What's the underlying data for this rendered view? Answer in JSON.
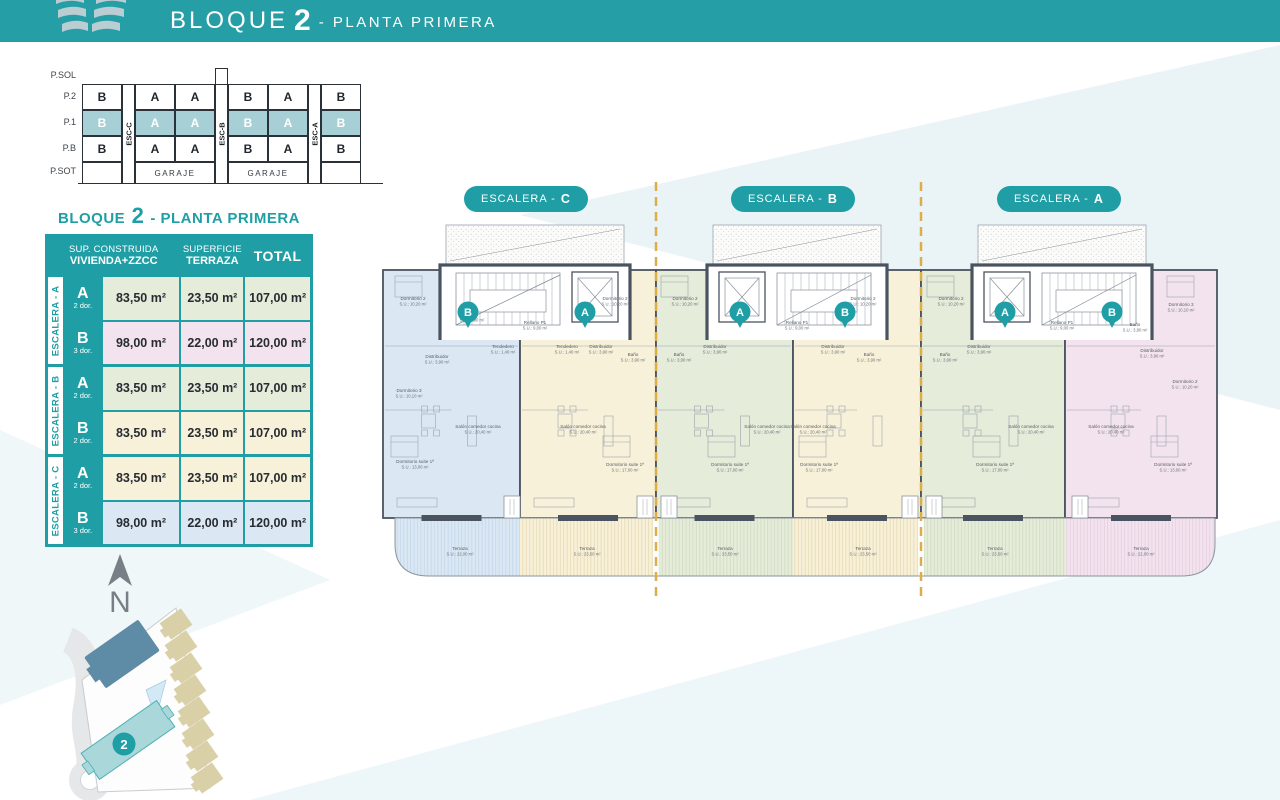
{
  "header": {
    "title_prefix": "BLOQUE",
    "title_number": "2",
    "title_suffix": "- PLANTA PRIMERA"
  },
  "colors": {
    "teal": "#1f9fa5",
    "wall": "#4a5360",
    "dash": "#dcae4b",
    "blue": "#dbe8f4",
    "cream": "#f8f1d9",
    "green": "#e5ecda",
    "pink": "#f3e3ee",
    "hblue": "#bdd3e8",
    "hcream": "#e3d6ab",
    "hgreen": "#ccd8bd",
    "hpink": "#e3cbdc"
  },
  "section_diagram": {
    "floors": [
      "P.SOL",
      "P.2",
      "P.1",
      "P.B",
      "P.SOT"
    ],
    "p2": [
      "B",
      "A",
      "A",
      "B",
      "A",
      "B"
    ],
    "p1": [
      "B",
      "A",
      "A",
      "B",
      "A",
      "B"
    ],
    "pb": [
      "B",
      "A",
      "A",
      "B",
      "A",
      "B"
    ],
    "esc": [
      "ESC-C",
      "ESC-B",
      "ESC-A"
    ],
    "garaje_left": "GARAJE",
    "garaje_right": "GARAJE"
  },
  "table": {
    "title_prefix": "BLOQUE",
    "title_number": "2",
    "title_suffix": "- PLANTA PRIMERA",
    "h_col1a": "SUP. CONSTRUIDA",
    "h_col1b": "VIVIENDA+ZZCC",
    "h_col2a": "SUPERFICIE",
    "h_col2b": "TERRAZA",
    "h_col3": "TOTAL",
    "groups": [
      {
        "label": "ESCALERA - A",
        "rows": [
          {
            "unit": "A",
            "dorms": "2 dor.",
            "sup": "83,50 m²",
            "terraza": "23,50 m²",
            "total": "107,00 m²",
            "bg": "#e5ecda"
          },
          {
            "unit": "B",
            "dorms": "3 dor.",
            "sup": "98,00 m²",
            "terraza": "22,00 m²",
            "total": "120,00 m²",
            "bg": "#f3e3ee"
          }
        ]
      },
      {
        "label": "ESCALERA - B",
        "rows": [
          {
            "unit": "A",
            "dorms": "2 dor.",
            "sup": "83,50 m²",
            "terraza": "23,50 m²",
            "total": "107,00 m²",
            "bg": "#e5ecda"
          },
          {
            "unit": "B",
            "dorms": "2 dor.",
            "sup": "83,50 m²",
            "terraza": "23,50 m²",
            "total": "107,00 m²",
            "bg": "#f8f1d9"
          }
        ]
      },
      {
        "label": "ESCALERA - C",
        "rows": [
          {
            "unit": "A",
            "dorms": "2 dor.",
            "sup": "83,50 m²",
            "terraza": "23,50 m²",
            "total": "107,00 m²",
            "bg": "#f8f1d9"
          },
          {
            "unit": "B",
            "dorms": "3 dor.",
            "sup": "98,00 m²",
            "terraza": "22,00 m²",
            "total": "120,00 m²",
            "bg": "#dbe8f4"
          }
        ]
      }
    ]
  },
  "plan": {
    "pills": [
      {
        "text": "ESCALERA -",
        "letter": "C"
      },
      {
        "text": "ESCALERA -",
        "letter": "B"
      },
      {
        "text": "ESCALERA -",
        "letter": "A"
      }
    ],
    "pins": [
      {
        "x": 93,
        "y": 134,
        "letter": "B"
      },
      {
        "x": 210,
        "y": 134,
        "letter": "A"
      },
      {
        "x": 365,
        "y": 134,
        "letter": "A"
      },
      {
        "x": 470,
        "y": 134,
        "letter": "B"
      },
      {
        "x": 630,
        "y": 134,
        "letter": "A"
      },
      {
        "x": 737,
        "y": 134,
        "letter": "B"
      }
    ],
    "rooms": [
      {
        "x": 38,
        "y": 122,
        "n": "Dormitorio 2",
        "s": "S.U.: 10,20 m²"
      },
      {
        "x": 97,
        "y": 138,
        "n": "Baño",
        "s": "S.U.: 3,90 m²"
      },
      {
        "x": 62,
        "y": 180,
        "n": "Distribuidor",
        "s": "S.U.: 3,90 m²"
      },
      {
        "x": 34,
        "y": 214,
        "n": "Dormitorio 3",
        "s": "S.U.: 10,10 m²"
      },
      {
        "x": 103,
        "y": 250,
        "n": "Salón comedor cocina",
        "s": "S.U.: 20,40 m²"
      },
      {
        "x": 40,
        "y": 285,
        "n": "Dormitorio suite 1ª",
        "s": "S.U.: 13,00 m²"
      },
      {
        "x": 128,
        "y": 170,
        "n": "Tendedero",
        "s": "S.U.: 1,40 m²"
      },
      {
        "x": 85,
        "y": 372,
        "n": "Terraza",
        "s": "S.U.: 22,00 m²"
      },
      {
        "x": 240,
        "y": 122,
        "n": "Dormitorio 2",
        "s": "S.U.: 10,20 m²"
      },
      {
        "x": 258,
        "y": 178,
        "n": "Baño",
        "s": "S.U.: 3,90 m²"
      },
      {
        "x": 226,
        "y": 170,
        "n": "Distribuidor",
        "s": "S.U.: 3,90 m²"
      },
      {
        "x": 192,
        "y": 170,
        "n": "Tendedero",
        "s": "S.U.: 1,40 m²"
      },
      {
        "x": 208,
        "y": 250,
        "n": "Salón comedor cocina",
        "s": "S.U.: 20,40 m²"
      },
      {
        "x": 250,
        "y": 288,
        "n": "Dormitorio suite 1ª",
        "s": "S.U.: 17,00 m²"
      },
      {
        "x": 212,
        "y": 372,
        "n": "Terraza",
        "s": "S.U.: 23,50 m²"
      },
      {
        "x": 310,
        "y": 122,
        "n": "Dormitorio 2",
        "s": "S.U.: 10,20 m²"
      },
      {
        "x": 304,
        "y": 178,
        "n": "Baño",
        "s": "S.U.: 3,90 m²"
      },
      {
        "x": 340,
        "y": 170,
        "n": "Distribuidor",
        "s": "S.U.: 3,90 m²"
      },
      {
        "x": 355,
        "y": 288,
        "n": "Dormitorio suite 1ª",
        "s": "S.U.: 17,00 m²"
      },
      {
        "x": 392,
        "y": 250,
        "n": "Salón comedor cocina",
        "s": "S.U.: 20,40 m²"
      },
      {
        "x": 350,
        "y": 372,
        "n": "Terraza",
        "s": "S.U.: 23,50 m²"
      },
      {
        "x": 488,
        "y": 122,
        "n": "Dormitorio 2",
        "s": "S.U.: 10,20 m²"
      },
      {
        "x": 494,
        "y": 178,
        "n": "Baño",
        "s": "S.U.: 3,90 m²"
      },
      {
        "x": 458,
        "y": 170,
        "n": "Distribuidor",
        "s": "S.U.: 3,90 m²"
      },
      {
        "x": 444,
        "y": 288,
        "n": "Dormitorio suite 1ª",
        "s": "S.U.: 17,00 m²"
      },
      {
        "x": 438,
        "y": 250,
        "n": "Salón comedor cocina",
        "s": "S.U.: 20,40 m²"
      },
      {
        "x": 488,
        "y": 372,
        "n": "Terraza",
        "s": "S.U.: 23,50 m²"
      },
      {
        "x": 576,
        "y": 122,
        "n": "Dormitorio 2",
        "s": "S.U.: 10,20 m²"
      },
      {
        "x": 570,
        "y": 178,
        "n": "Baño",
        "s": "S.U.: 3,90 m²"
      },
      {
        "x": 604,
        "y": 170,
        "n": "Distribuidor",
        "s": "S.U.: 3,90 m²"
      },
      {
        "x": 620,
        "y": 288,
        "n": "Dormitorio suite 1ª",
        "s": "S.U.: 17,00 m²"
      },
      {
        "x": 656,
        "y": 250,
        "n": "Salón comedor cocina",
        "s": "S.U.: 20,40 m²"
      },
      {
        "x": 620,
        "y": 372,
        "n": "Terraza",
        "s": "S.U.: 23,50 m²"
      },
      {
        "x": 806,
        "y": 128,
        "n": "Dormitorio 3",
        "s": "S.U.: 10,10 m²"
      },
      {
        "x": 760,
        "y": 148,
        "n": "Baño",
        "s": "S.U.: 3,90 m²"
      },
      {
        "x": 777,
        "y": 174,
        "n": "Distribuidor",
        "s": "S.U.: 3,90 m²"
      },
      {
        "x": 810,
        "y": 205,
        "n": "Dormitorio 2",
        "s": "S.U.: 10,20 m²"
      },
      {
        "x": 736,
        "y": 250,
        "n": "Salón comedor cocina",
        "s": "S.U.: 20,40 m²"
      },
      {
        "x": 798,
        "y": 288,
        "n": "Dormitorio suite 1ª",
        "s": "S.U.: 13,00 m²"
      },
      {
        "x": 766,
        "y": 372,
        "n": "Terraza",
        "s": "S.U.: 22,00 m²"
      },
      {
        "x": 160,
        "y": 146,
        "n": "Rellano P1",
        "s": "S.U.: 9,00 m²"
      },
      {
        "x": 422,
        "y": 146,
        "n": "Rellano P1",
        "s": "S.U.: 9,00 m²"
      },
      {
        "x": 687,
        "y": 146,
        "n": "Rellano P1",
        "s": "S.U.: 9,00 m²"
      }
    ]
  },
  "sitemap": {
    "north_label": "N",
    "block_badge": "2"
  }
}
